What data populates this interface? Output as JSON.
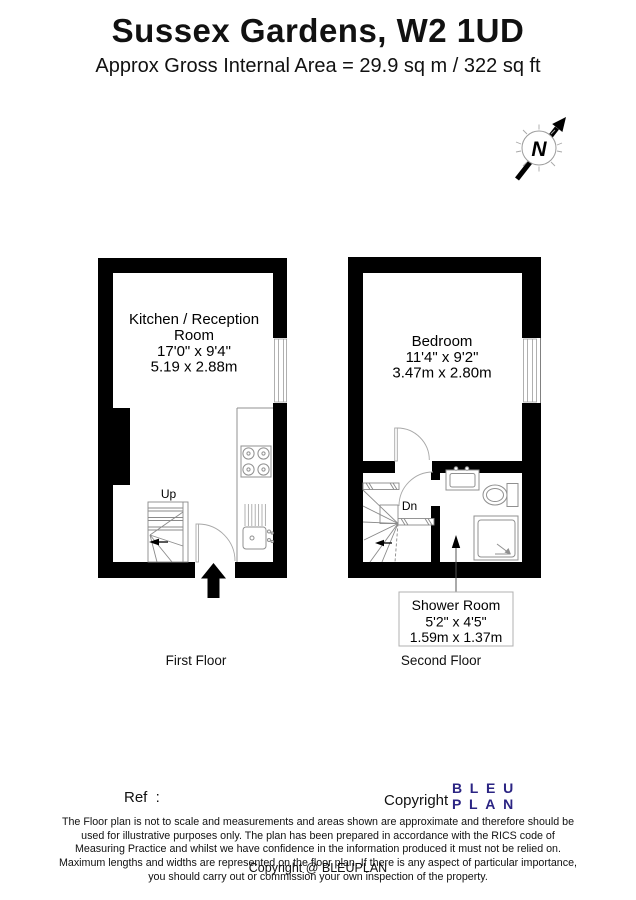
{
  "header": {
    "title": "Sussex Gardens, W2 1UD",
    "subtitle": "Approx Gross Internal Area = 29.9 sq m / 322 sq ft"
  },
  "compass": {
    "north_label": "N"
  },
  "floors": [
    {
      "name": "First Floor",
      "room": {
        "name_line1": "Kitchen / Reception",
        "name_line2": "Room",
        "dims_imperial": "17'0\" x 9'4\"",
        "dims_metric": "5.19 x 2.88m"
      },
      "stairs_label": "Up"
    },
    {
      "name": "Second Floor",
      "room": {
        "name": "Bedroom",
        "dims_imperial": "11'4\" x 9'2\"",
        "dims_metric": "3.47m x 2.80m"
      },
      "stairs_label": "Dn",
      "callout": {
        "name": "Shower Room",
        "dims_imperial": "5'2\" x 4'5\"",
        "dims_metric": "1.59m x 1.37m"
      }
    }
  ],
  "footer": {
    "ref_label": "Ref  :",
    "copyright_label": "Copyright",
    "logo_line1": "BLEU",
    "logo_line2": "PLAN",
    "logo_color": "#2b2483",
    "disclaimer": "The Floor plan is not to scale and measurements and areas shown are approximate and therefore should be used for illustrative purposes only. The plan has been prepared in accordance with the RICS code of Measuring Practice and whilst we have confidence in the information produced it must not be relied on. Maximum lengths and widths are represented on the floor plan. If there is any aspect of particular importance, you should carry out or commission your own inspection of the property.",
    "copyright_line": "Copyright @ BLEUPLAN"
  }
}
